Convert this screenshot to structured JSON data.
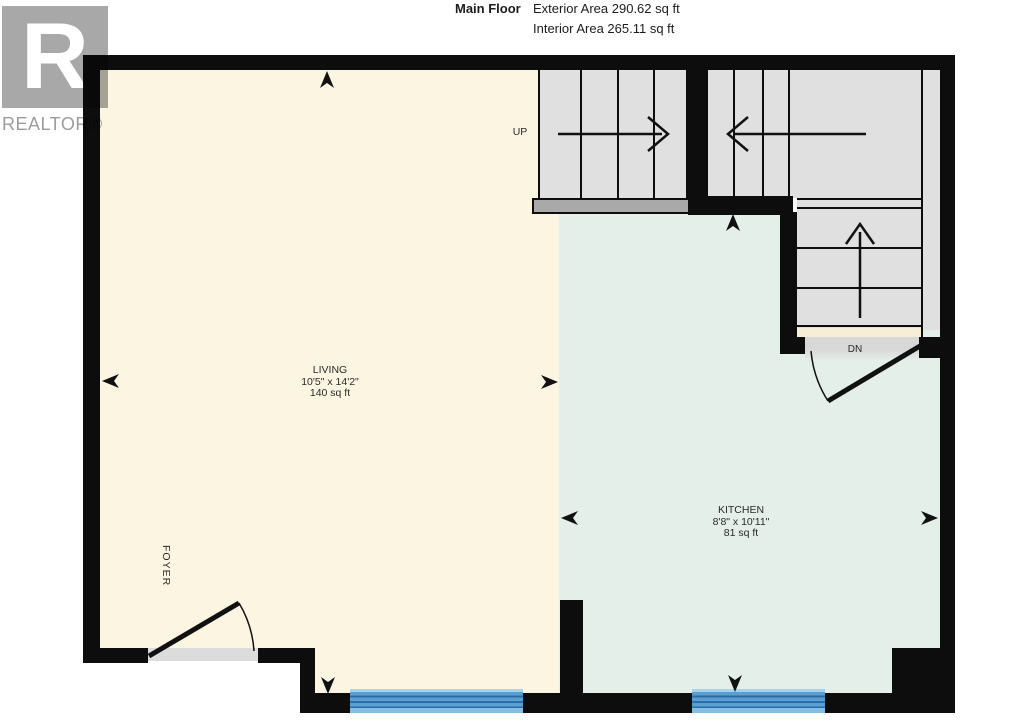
{
  "header": {
    "title": "Main Floor",
    "exterior_area": "Exterior Area 290.62 sq ft",
    "interior_area": "Interior Area 265.11 sq ft"
  },
  "logo": {
    "letter": "R",
    "label": "REALTOR®"
  },
  "rooms": {
    "living": {
      "name": "LIVING",
      "dimensions": "10'5\" x 14'2\"",
      "area": "140 sq ft"
    },
    "kitchen": {
      "name": "KITCHEN",
      "dimensions": "8'8\" x 10'11\"",
      "area": "81 sq ft"
    },
    "foyer": {
      "name": "FOYER"
    }
  },
  "stairs": {
    "up_label": "UP",
    "down_label": "DN"
  },
  "colors": {
    "wall": "#0d0d0d",
    "living_floor": "#fcf5e2",
    "kitchen_floor": "#e5efe9",
    "stair_tread": "#e0e0e0",
    "landing_bar": "#a9a9a9",
    "threshold": "#dcdcdc",
    "dn_gray": "#d8d8d8",
    "window_blue": "#5b9fd2",
    "window_line": "#2b6ea9",
    "logo_gray": "#a8a8a8"
  }
}
